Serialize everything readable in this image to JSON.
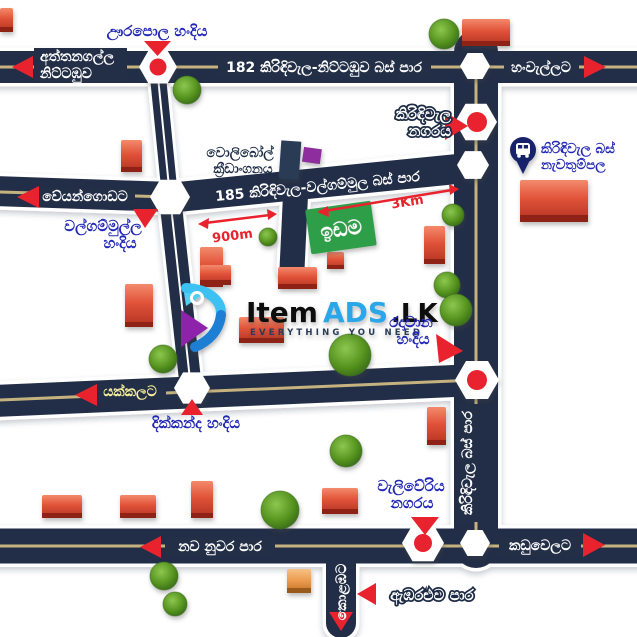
{
  "colors": {
    "road_navy": "#232f47",
    "center_line_tan": "#c6b27e",
    "marker_red": "#e8232e",
    "label_blue": "#2228b4",
    "land_green": "#2f9e49",
    "logo_blue": "#2aa7e8",
    "bus_pin_navy": "#15246b"
  },
  "roads": {
    "route182_label": "182 කිරිඳිවැල-නිට්ටඹුව බස් පාර",
    "attanagalla_line1": "අත්තනගල්ල",
    "attanagalla_line2": "නිට්ටඹුව",
    "hanwella_dest": "හංවැල්ලට",
    "veyangoda_dest": "වේයන්ගොඩට",
    "route185_label": "185 කිරිඳිවැල-වල්ගම්මුල බස් පාර",
    "yakkala_dest": "යක්කලට",
    "nawa_nuwara_road": "නව නුවර පාර",
    "kaduwela_dest": "කඩුවෙලට",
    "ambaraluwa_road": "ඇඹරළුව පාර",
    "kirindiwela_bus_road": "කිරිඳිවැල බස් පාර",
    "colombo_dest": "කොළඹට"
  },
  "junctions": {
    "urapola": "ඌරපොල හංදිය",
    "walgammulla_1": "වල්ගම්මුල්ල",
    "walgammulla_2": "හංදිය",
    "kirindiwela_town_1": "කිරිඳිවැල",
    "kirindiwela_town_2": "නගරය",
    "radawana_1": "රදාවාන",
    "radawana_2": "හංදිය",
    "dikkanda": "දික්කන්ද හංදිය",
    "weliweriya_1": "වැලිවේරිය",
    "weliweriya_2": "නගරය"
  },
  "pois": {
    "volleyball_1": "වොලිබෝල්",
    "volleyball_2": "ක්‍රීඩාංගනය",
    "bus_stop_1": "කිරිඳිවැල බස්",
    "bus_stop_2": "නැවතුම්පල",
    "land_sign": "ඉඩම"
  },
  "measurements": {
    "west_segment": "900m",
    "east_segment": "3Km"
  },
  "logo": {
    "word1": "Item",
    "word2": "ADS",
    "word3": ".LK",
    "tagline": "EVERYTHING YOU NEED"
  }
}
